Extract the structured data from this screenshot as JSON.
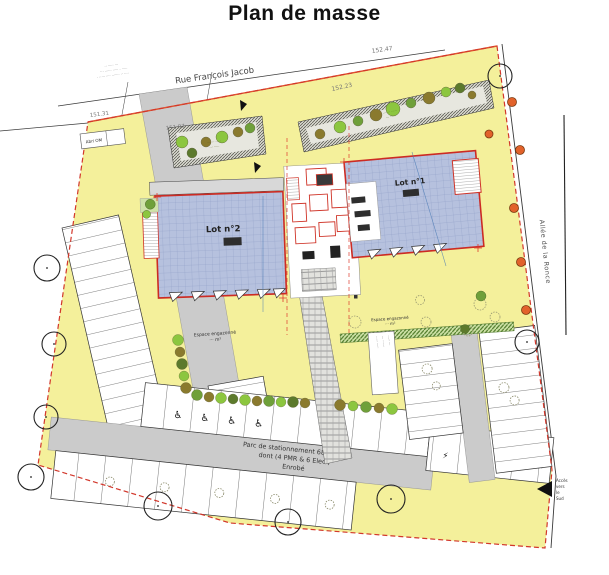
{
  "title": "Plan de masse",
  "streets": {
    "north": "Rue François Jacob",
    "east": "Allée de la Ronce"
  },
  "dims": {
    "d47": "152.47",
    "d23": "152.23",
    "d97": "151.97",
    "d31": "151.31"
  },
  "lots": {
    "lot1": "Lot n°1",
    "lot2": "Lot n°2"
  },
  "parking": {
    "l1": "Parc de stationnement 68 places",
    "l2": "dont (4 PMR & 6 Elec.)",
    "l3": "Enrobé",
    "pmr": "♿",
    "elec": "⚡"
  },
  "lawn": {
    "left_l1": "Espace engazonné",
    "left_l2": "··· m²",
    "right_l1": "Espace engazonné",
    "right_l2": "··· m²"
  },
  "notes": {
    "abri": "Abri OM",
    "street": [
      "·· ····· ···",
      "··· ······ ····· · ·····",
      "· ····· ···· ······· ·· ····"
    ],
    "bed1": [
      "···· ·· ·····",
      "··· ·····"
    ],
    "bed2": [
      "···· ·· ·····",
      "··· ·····"
    ],
    "path": [
      "····· ·····",
      "··· ······",
      "····· ···"
    ],
    "south": [
      "Accès",
      "vers",
      "le",
      "Sud"
    ]
  },
  "colors": {
    "site_yellow": "#f4f09b",
    "roof_blue": "#b6c1de",
    "outline_red": "#d2372b",
    "road_gray": "#cbcbcb",
    "hedge_green": "#4e7a28",
    "tree_green": "#8cc63f",
    "tree_olive": "#8a7a2e",
    "tree_orange": "#e2622b"
  }
}
